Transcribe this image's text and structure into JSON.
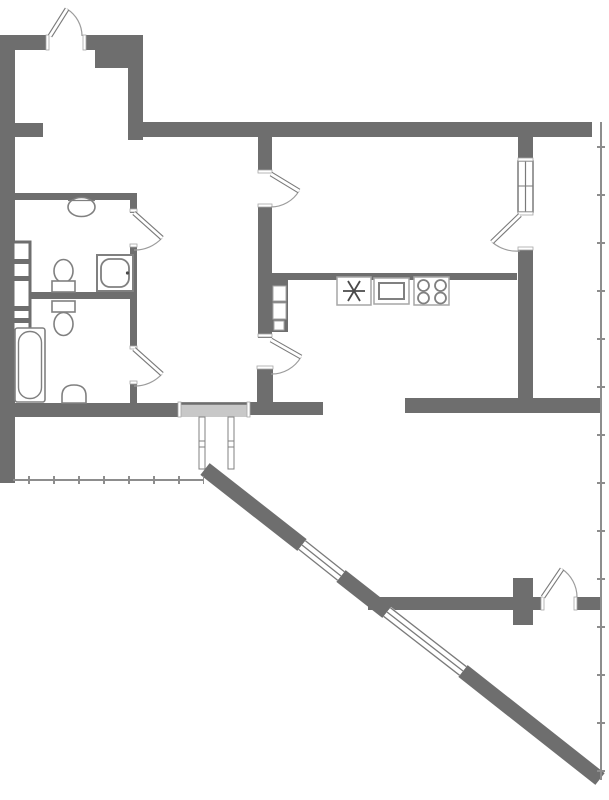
{
  "canvas": {
    "width": 609,
    "height": 800,
    "background": "#ffffff"
  },
  "colors": {
    "wall": "#6e6e6e",
    "partition": "#6e6e6e",
    "fixture": "#808080",
    "fixture_light": "#a6a6a6",
    "door_leaf_outline": "#7a7a7a",
    "door_arc": "#9c9c9c",
    "window_line": "#7a7a7a",
    "railing": "#8d8d8d",
    "threshold": "#c8c8c8",
    "symbol": "#4a4a4a",
    "white": "#ffffff"
  },
  "plan": {
    "type": "apartment-floor-plan",
    "doors": [
      {
        "name": "top-left-entrance-door"
      },
      {
        "name": "wc-door"
      },
      {
        "name": "bathroom-door"
      },
      {
        "name": "living-room-door"
      },
      {
        "name": "balcony-door-right"
      },
      {
        "name": "kitchen-door"
      },
      {
        "name": "loggia-door-bottom"
      },
      {
        "name": "main-entry-opening"
      }
    ],
    "windows": [
      {
        "name": "right-glazed-partition"
      },
      {
        "name": "diagonal-window-1"
      },
      {
        "name": "diagonal-window-2"
      }
    ],
    "fixtures": [
      {
        "name": "wash-basin-wc"
      },
      {
        "name": "toilet-wc"
      },
      {
        "name": "shower-cabin"
      },
      {
        "name": "toilet-bathroom"
      },
      {
        "name": "bathtub"
      },
      {
        "name": "pedestal-sink-bathroom"
      },
      {
        "name": "kitchen-sink-symbol"
      },
      {
        "name": "oven-unit"
      },
      {
        "name": "cooktop-4-burner"
      },
      {
        "name": "vent-shaft-bathroom"
      },
      {
        "name": "vent-shaft-kitchen"
      },
      {
        "name": "balcony-railing-right"
      },
      {
        "name": "balcony-railing-bottom-left"
      },
      {
        "name": "entry-vestibule-lines"
      }
    ]
  }
}
